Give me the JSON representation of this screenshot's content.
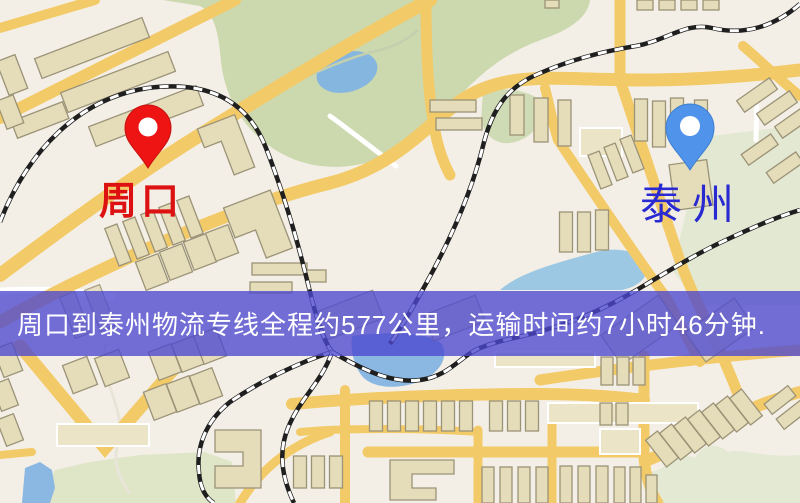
{
  "origin": {
    "label": "周口",
    "pin": "red-map-pin",
    "pin_color": "#ee1414",
    "label_color": "#dd1111"
  },
  "destination": {
    "label": "泰州",
    "pin": "blue-map-pin",
    "pin_color": "#4f93ea",
    "label_color": "#2a2ad2"
  },
  "banner": {
    "text": "周口到泰州物流专线全程约577公里，运输时间约7小时46分钟.",
    "background_color": "#504cd0",
    "text_color": "#ffffff"
  },
  "map_colors": {
    "background": "#f4efe6",
    "park_green": "#ccd8ae",
    "park_pale": "#e3e8d2",
    "water_blue": "#85b6e0",
    "road_yellow": "#f3ca68",
    "building_tan": "#e5dcb9",
    "railway_black": "#1f1f1f"
  }
}
